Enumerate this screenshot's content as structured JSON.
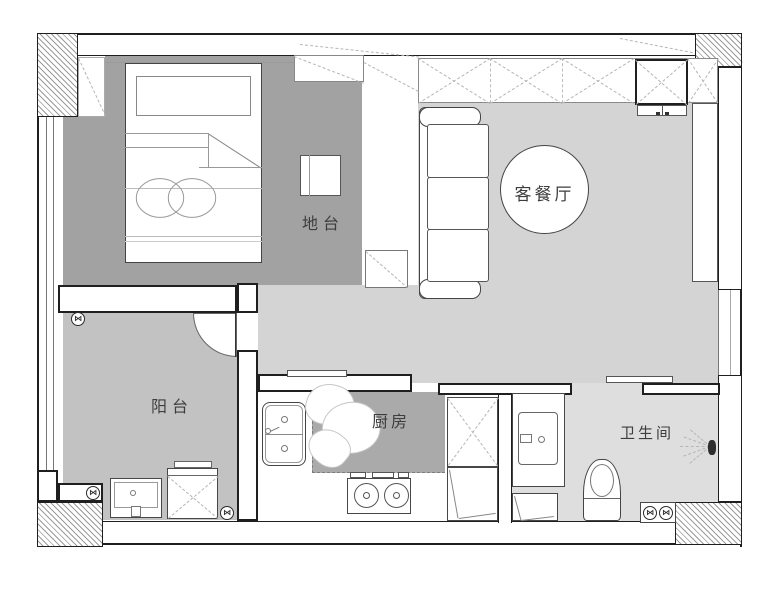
{
  "rooms": {
    "living_dining": {
      "label": "客餐厅"
    },
    "platform": {
      "label": "地台"
    },
    "balcony": {
      "label": "阳台"
    },
    "kitchen": {
      "label": "厨房"
    },
    "bathroom": {
      "label": "卫生间"
    }
  },
  "symbols": {
    "floor_drain": "⋈"
  },
  "colors": {
    "floor_platform": "#a2a2a2",
    "floor_living": "#d4d4d4",
    "floor_balcony": "#c2c2c2",
    "floor_kitchen": "#aaaaaa",
    "floor_bathroom": "#dedede",
    "wall_line": "#1f1f1f",
    "label_text": "#3d3d3d"
  }
}
